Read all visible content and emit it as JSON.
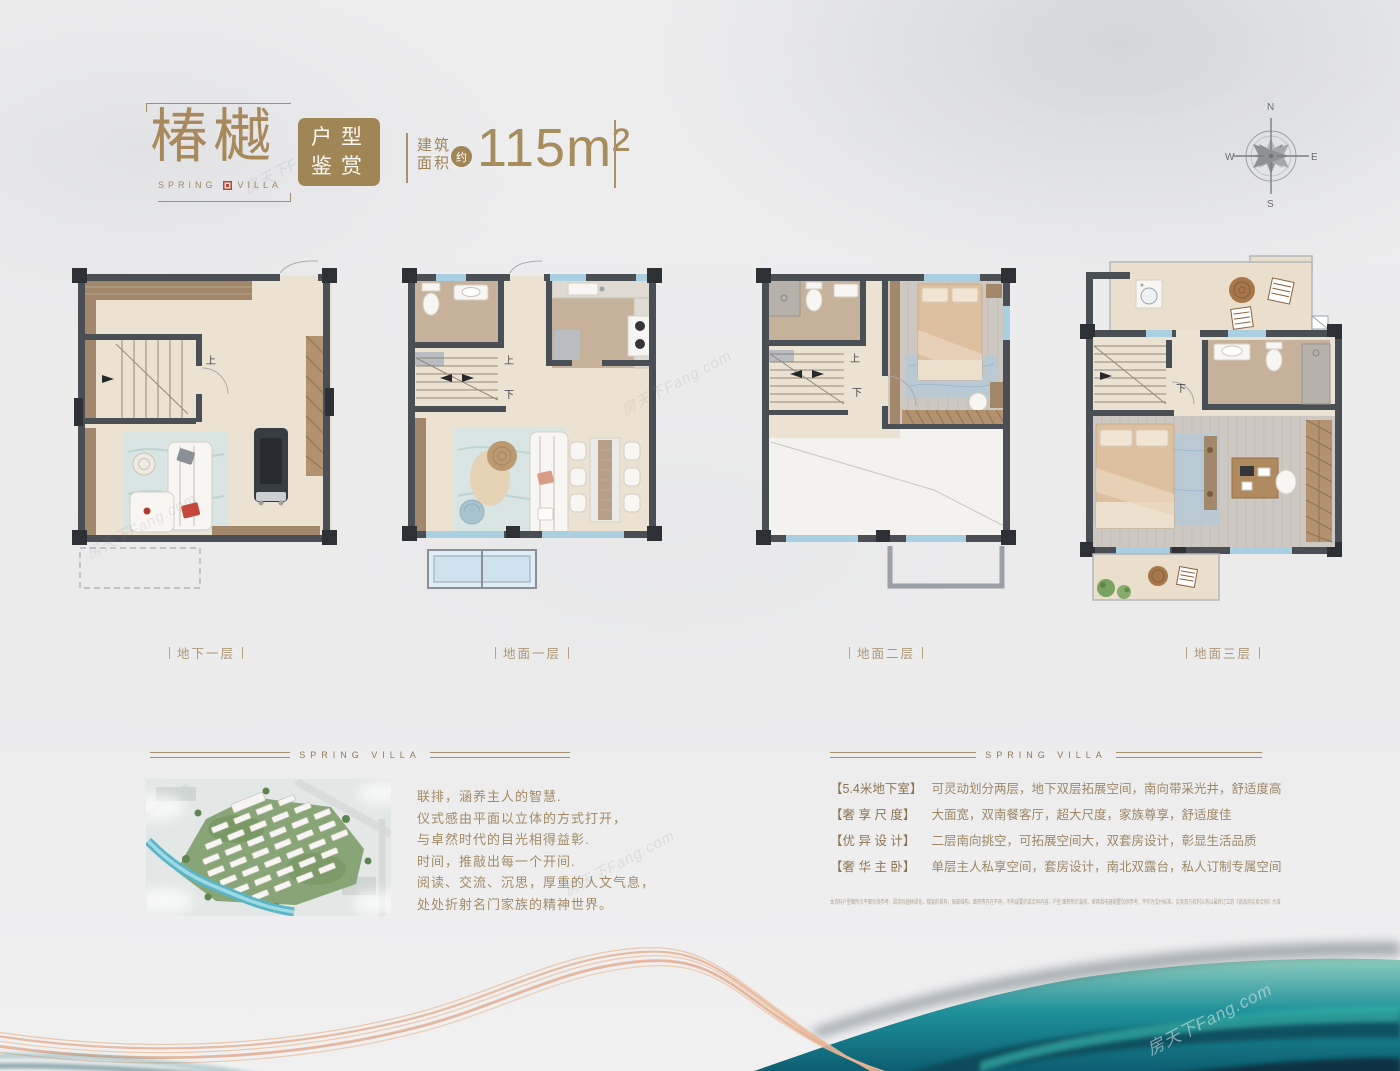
{
  "header": {
    "title": "椿樾",
    "sub_left": "SPRING",
    "sub_right": "VILLA",
    "badge": {
      "line1": "户型",
      "line2": "鉴赏"
    },
    "area": {
      "label1": "建筑",
      "label2": "面积",
      "approx": "约",
      "value": "115m²"
    }
  },
  "compass": {
    "north": "N",
    "east": "E",
    "south": "S",
    "west": "W"
  },
  "plans": {
    "basement": {
      "label": "地下一层",
      "stair_up": "上"
    },
    "floor1": {
      "label": "地面一层",
      "stair_up": "上",
      "stair_down": "下"
    },
    "floor2": {
      "label": "地面二层",
      "stair_up": "上",
      "stair_down": "下"
    },
    "floor3": {
      "label": "地面三层",
      "stair_down": "下"
    }
  },
  "section_rule_label": "SPRING VILLA",
  "poem": {
    "lines": [
      "联排，涵养主人的智慧.",
      "仪式感由平面以立体的方式打开，",
      "与卓然时代的目光相得益彰.",
      "时间，推敲出每一个开间.",
      "阅读、交流、沉思，厚重的人文气息，",
      "处处折射名门家族的精神世界。"
    ]
  },
  "features": [
    {
      "tag": "【5.4米地下室】",
      "desc": "可灵动划分两层，地下双层拓展空间，南向带采光井，舒适度高"
    },
    {
      "tag": "【奢 享 尺 度】",
      "desc": "大面宽，双南餐客厅，超大尺度，家族尊享，舒适度佳"
    },
    {
      "tag": "【优 异 设 计】",
      "desc": "二层南向挑空，可拓展空间大，双套房设计，彰显生活品质"
    },
    {
      "tag": "【奢 华 主 卧】",
      "desc": "单层主人私享空间，套房设计，南北双露台，私人订制专属空间"
    }
  ],
  "disclaimer": "本资料户型图所示平面仅供参考，因实际园林绿化、楼层的差异，局部结构、面积等存在不同，不构成要约或合同内容，户型 面积所示装修、家具和电器配置仅供参考，不作为交付标准，买卖双方权利义务以最终订立的《商品房买卖合同》为准",
  "watermark": "房天下Fang.com",
  "colors": {
    "gold": "#a5895e",
    "wall": "#4a4f55",
    "window": "#a9cfe0",
    "teal": "#157f8c",
    "peach": "#e8b897"
  }
}
